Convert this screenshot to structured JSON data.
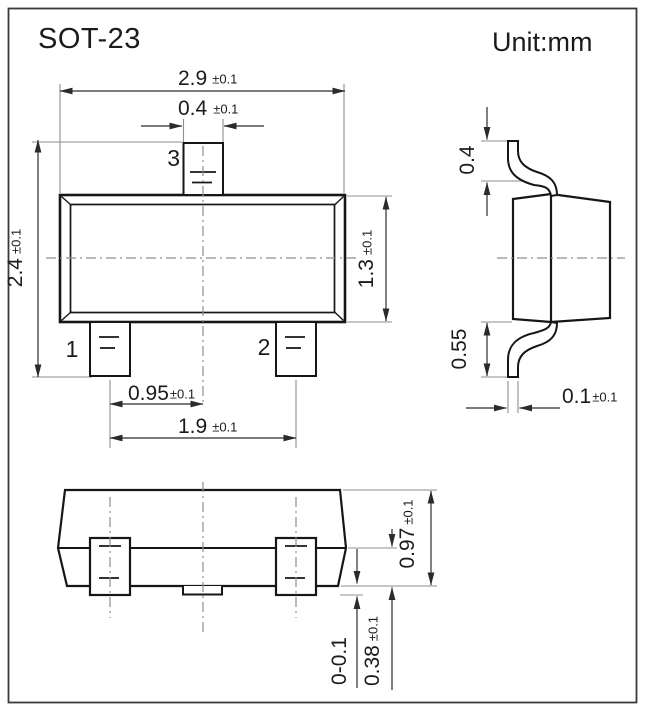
{
  "header": {
    "title": "SOT-23",
    "unit": "Unit:mm"
  },
  "top_view": {
    "pins": {
      "p1": "1",
      "p2": "2",
      "p3": "3"
    },
    "dims": {
      "body_width": {
        "value": "2.9",
        "tol": "±0.1"
      },
      "lead_width": {
        "value": "0.4",
        "tol": "±0.1"
      },
      "total_height": {
        "value": "2.4",
        "tol": "±0.1"
      },
      "body_height": {
        "value": "1.3",
        "tol": "±0.1"
      },
      "pitch": {
        "value": "0.95",
        "tol": "±0.1"
      },
      "span": {
        "value": "1.9",
        "tol": "±0.1"
      }
    }
  },
  "side_view": {
    "dims": {
      "lead_top_length": "0.4",
      "lead_bottom_length": "0.55",
      "lead_thickness": {
        "value": "0.1",
        "tol": "±0.1"
      }
    }
  },
  "front_view": {
    "dims": {
      "body_height": {
        "value": "0.97",
        "tol": "±0.1"
      },
      "lead_height": {
        "value": "0.38",
        "tol": "±0.1"
      },
      "standoff": "0-0.1"
    }
  }
}
